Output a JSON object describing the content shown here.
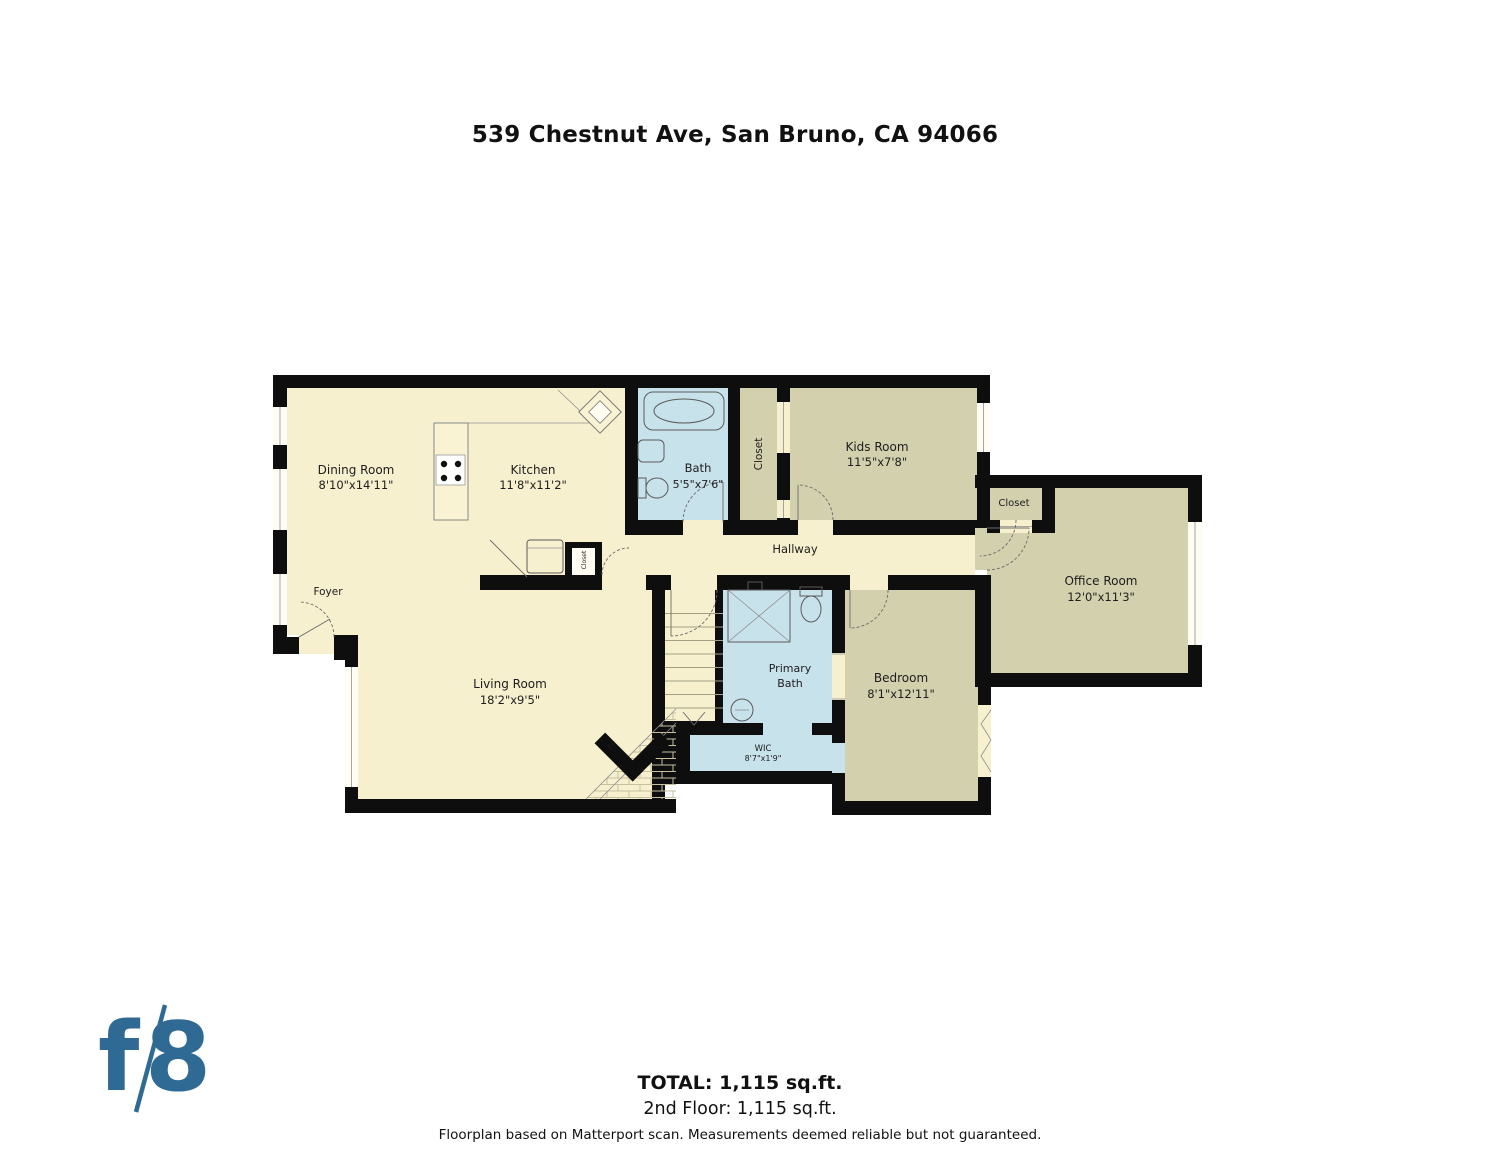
{
  "header": {
    "title": "539 Chestnut Ave, San Bruno, CA 94066"
  },
  "floorplan": {
    "rooms": {
      "dining": {
        "name": "Dining Room",
        "dims": "8'10\"x14'11\""
      },
      "kitchen": {
        "name": "Kitchen",
        "dims": "11'8\"x11'2\""
      },
      "bath": {
        "name": "Bath",
        "dims": "5'5\"x7'6\""
      },
      "hall_closet": {
        "name": "Closet"
      },
      "kids_room": {
        "name": "Kids Room",
        "dims": "11'5\"x7'8\""
      },
      "office_closet": {
        "name": "Closet"
      },
      "hallway": {
        "name": "Hallway"
      },
      "office": {
        "name": "Office Room",
        "dims": "12'0\"x11'3\""
      },
      "foyer": {
        "name": "Foyer"
      },
      "living": {
        "name": "Living Room",
        "dims": "18'2\"x9'5\""
      },
      "primary_bath": {
        "line1": "Primary",
        "line2": "Bath"
      },
      "wic": {
        "name": "WIC",
        "dims": "8'7\"x1'9\""
      },
      "bedroom": {
        "name": "Bedroom",
        "dims": "8'1\"x12'11\""
      },
      "kitchen_closet": {
        "name": "Closet"
      },
      "fireplace": {
        "label": "FP"
      }
    },
    "colors": {
      "wall": "#0e0e0e",
      "floor_main": "#f6f0cf",
      "floor_rooms": "#d3d0ae",
      "floor_bath": "#c8e2ec",
      "logo_blue": "#2f6a94"
    }
  },
  "footer": {
    "logo": {
      "f": "f",
      "slash": "/",
      "eight": "8"
    },
    "total": "TOTAL: 1,115 sq.ft.",
    "floor_line": "2nd Floor: 1,115 sq.ft.",
    "disclaimer": "Floorplan based on Matterport scan. Measurements deemed reliable but not guaranteed."
  }
}
